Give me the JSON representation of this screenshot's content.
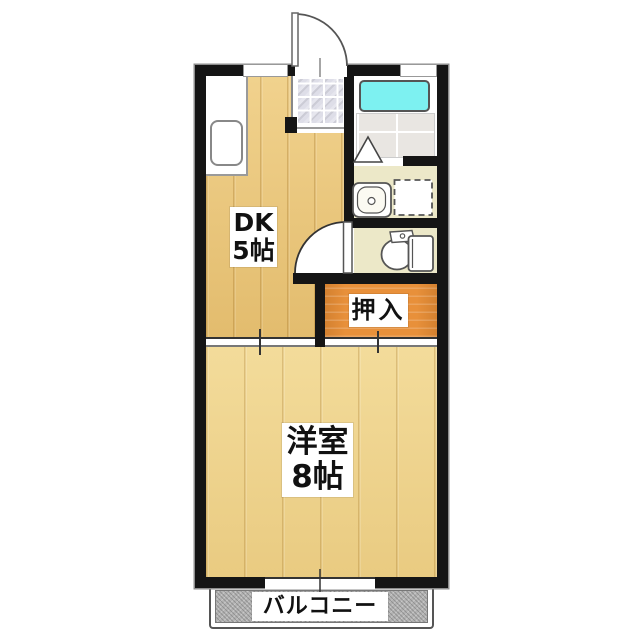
{
  "floor_plan": {
    "type": "japanese-apartment-floor-plan",
    "rooms": {
      "dk": {
        "label_line1": "DK",
        "label_line2": "5帖"
      },
      "western": {
        "label_line1": "洋室",
        "label_line2": "8帖"
      },
      "closet": {
        "label": "押入"
      },
      "balcony": {
        "label": "バルコニー"
      }
    },
    "fixtures": [
      "kitchen-counter",
      "kitchen-sink",
      "entrance-door",
      "genkan-tile-floor",
      "bathtub",
      "bathroom-folding-door",
      "washbasin",
      "washing-machine-space",
      "toilet",
      "toilet-door",
      "sliding-doors",
      "balcony-window"
    ],
    "colors": {
      "wall": "#151515",
      "dk-floor": "#e9c476",
      "western-floor": "#eed289",
      "closet": "#e8903a",
      "service-floor": "#ece8c8",
      "bathtub": "#7df1f1",
      "bath-floor": "#e9e6e2",
      "tile": "#d9dae3",
      "balcony": "#b3b3b3",
      "label-bg": "#ffffff",
      "label-text": "#111111"
    }
  }
}
